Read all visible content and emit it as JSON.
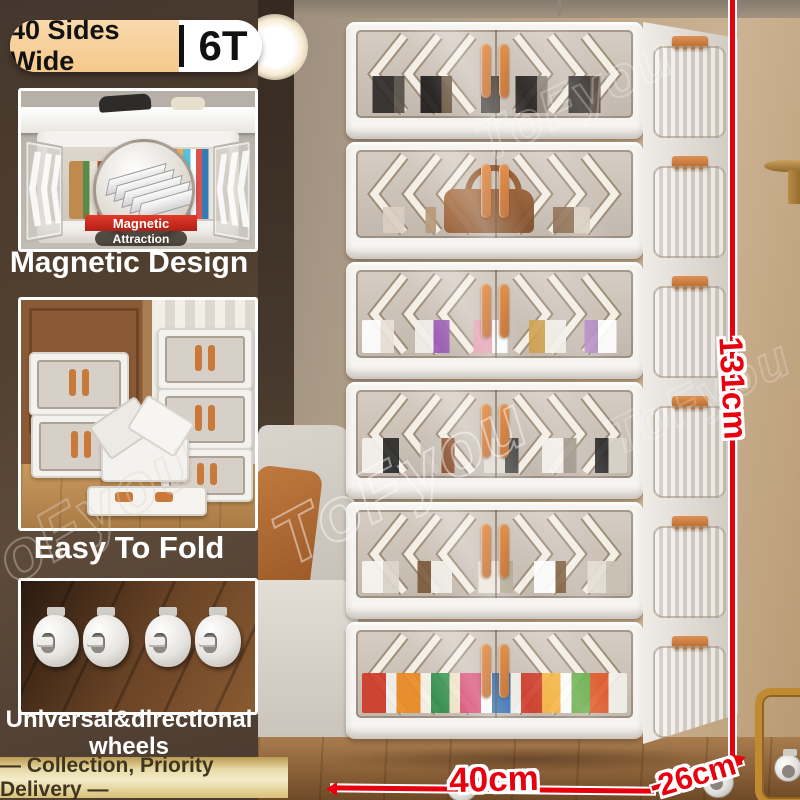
{
  "badge": {
    "left_label": "40 Sides Wide",
    "right_label": "6T"
  },
  "features": [
    {
      "caption": "Magnetic Design",
      "inset_line1": "Magnetic",
      "inset_line2": "Attraction"
    },
    {
      "caption": "Easy To Fold"
    },
    {
      "caption_line1": "Universal&directional",
      "caption_line2": "wheels"
    }
  ],
  "banner_text": "— Collection, Priority Delivery —",
  "measurements": {
    "height_label": "131cm",
    "width_label": "40cm",
    "depth_label": "26cm"
  },
  "watermark_text": "ToFyou",
  "colors": {
    "accent_red": "#e8000f",
    "handle_orange": "#cf7a3c",
    "badge_peach": "#f8d09e",
    "banner_gold": "#e9d9a6",
    "left_background": "#4e3d33"
  }
}
